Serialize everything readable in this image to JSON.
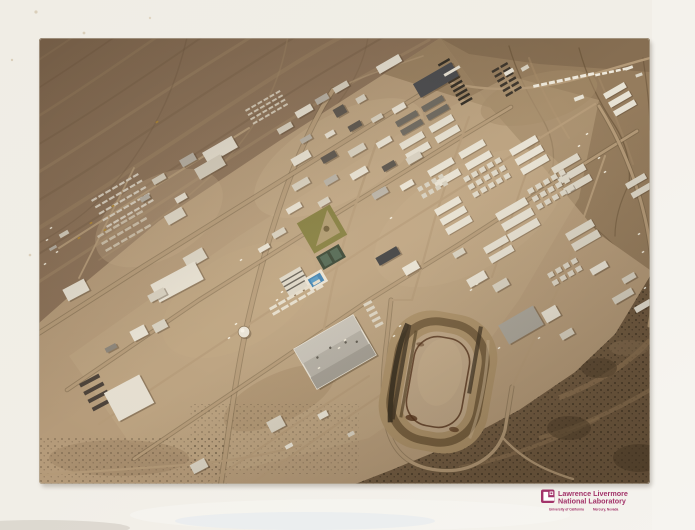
{
  "meta": {
    "title": "Glossy photographic print of an oblique aerial photograph",
    "subject": "Aerial view of a desert base-camp town with street grid, barracks rows, ball field, swimming pool and dirt racetrack, surrounded by alluvial fans, hills and scrub desert"
  },
  "label": {
    "org_line1": "Lawrence Livermore",
    "org_line2": "National Laboratory",
    "sub_left": "University of California",
    "sub_right": "Mercury, Nevada",
    "color": "#a23369"
  },
  "scene": {
    "colors": {
      "paper": "#f1eee7",
      "photo_base": "#b59b7a",
      "fan": "#8b7158",
      "fan_light": "#a68b6a",
      "fan_dark": "#6e573e",
      "hills": "#957c5d",
      "hills_dark": "#665036",
      "hills_light": "#b19671",
      "scrub": "#6f5940",
      "scrub_dot": "#3a2e1e",
      "wash": "#977c5a",
      "town_light": "#c2a986",
      "road": "#b49a78",
      "road_edge": "#6b583f",
      "roof_white": "#eae5d8",
      "roof_gray": "#b7b2a8",
      "roof_dark": "#45474c",
      "pool": "#3b7fb2",
      "field": "#7f7a3a",
      "field_dirt": "#b09a72",
      "tennis": "#31402f",
      "court": "#4a624f",
      "track_apron": "#ab9068",
      "track_berm": "#735c3c",
      "track_infield": "#bea687",
      "track_rail": "#5a3a22",
      "track_shadow": "#2b2316",
      "shadow": "#4a3a27",
      "vehicle": "#f2ecdc",
      "equipment": "#b58a2f"
    },
    "roads": [
      {
        "d": "M 182,446 C 190,390 198,330 210,278 C 220,234 238,170 258,122 C 266,103 274,86 284,68 L 294,52",
        "w": 4,
        "e": 1
      },
      {
        "d": "M 0,295 L 105,228 L 232,149 L 332,87 L 404,43",
        "w": 3.5,
        "e": 1
      },
      {
        "d": "M 28,352 L 160,262 L 300,174 L 422,99 L 472,69",
        "w": 2.8,
        "e": 1
      },
      {
        "d": "M 95,421 L 230,330 L 330,262 L 422,205 L 532,134 L 598,93",
        "w": 2.8,
        "e": 1
      },
      {
        "d": "M 60,386 L 200,293 L 340,201 L 480,113 L 556,66",
        "w": 2.2
      },
      {
        "d": "M 168,446 L 260,384 L 330,338",
        "w": 2
      },
      {
        "d": "M 212,446 L 300,385 L 352,350",
        "w": 2.2
      },
      {
        "d": "M 0,437 L 118,429 C 178,425 222,419 262,407",
        "w": 2.2
      },
      {
        "d": "M 338,103 L 322,150 L 306,200 L 294,245 L 285,290",
        "w": 2.4
      },
      {
        "d": "M 430,79 L 412,130 L 396,180 L 384,224 L 373,262",
        "w": 2.2
      },
      {
        "d": "M 500,99 L 482,150 L 466,200 L 453,239",
        "w": 2
      },
      {
        "d": "M 566,118 L 548,170 L 533,213 L 521,247",
        "w": 2
      },
      {
        "d": "M 560,68 C 580,100 597,140 606,180 C 615,219 616,255 610,288",
        "w": 3,
        "e": 1
      },
      {
        "d": "M 404,43 C 452,56 502,52 548,38 C 572,31 592,25 611,20",
        "w": 2.4
      },
      {
        "d": "M 294,52 C 324,38 354,28 384,18",
        "w": 1.6,
        "o": 0.6
      },
      {
        "d": "M 352,262 L 348,300 C 344,330 342,360 348,388 C 354,416 372,429 398,432 C 430,436 458,420 466,392 L 473,349",
        "w": 3.2,
        "e": 1
      },
      {
        "d": "M 464,400 C 482,420 504,432 534,441",
        "w": 2.4
      },
      {
        "d": "M 373,262 L 352,262",
        "w": 2
      },
      {
        "d": "M 20,210 L 120,146 L 210,90",
        "w": 2
      },
      {
        "d": "M 40,240 L 70,180 L 95,130",
        "w": 1.8
      },
      {
        "d": "M 473,349 L 521,247",
        "w": 2
      },
      {
        "d": "M 285,290 C 282,310 284,330 296,344",
        "w": 2
      }
    ],
    "buildings": [
      [
        350,
        26,
        26,
        8,
        -30,
        "#eae5d8"
      ],
      [
        397,
        42,
        44,
        16,
        -30,
        "#45474c"
      ],
      [
        413,
        33,
        18,
        3,
        -30,
        "#eae5d8"
      ],
      [
        302,
        49,
        16,
        6,
        -30,
        "#d9d3c4"
      ],
      [
        283,
        61,
        14,
        6,
        -30,
        "#b7b2a8"
      ],
      [
        265,
        73,
        18,
        7,
        -30,
        "#eae5d8"
      ],
      [
        301,
        73,
        12,
        9,
        -30,
        "#55504a"
      ],
      [
        322,
        61,
        10,
        6,
        -30,
        "#d9d3c4"
      ],
      [
        246,
        90,
        16,
        6,
        -30,
        "#d9d3c4"
      ],
      [
        267,
        101,
        12,
        5,
        -30,
        "#b7b2a8"
      ],
      [
        291,
        96,
        10,
        5,
        -30,
        "#eae5d8"
      ],
      [
        316,
        88,
        14,
        6,
        -30,
        "#55504a"
      ],
      [
        338,
        80,
        12,
        5,
        -30,
        "#d9d3c4"
      ],
      [
        360,
        70,
        14,
        6,
        -30,
        "#eae5d8"
      ],
      [
        181,
        112,
        34,
        13,
        -30,
        "#eae5d8"
      ],
      [
        171,
        129,
        30,
        12,
        -30,
        "#d9d3c4"
      ],
      [
        149,
        122,
        16,
        8,
        -30,
        "#b7b2a8"
      ],
      [
        120,
        141,
        14,
        6,
        -30,
        "#d9d3c4"
      ],
      [
        142,
        160,
        12,
        6,
        -30,
        "#eae5d8"
      ],
      [
        106,
        160,
        10,
        5,
        -30,
        "#b7b2a8"
      ],
      [
        136,
        178,
        20,
        10,
        -30,
        "#e2dccd"
      ],
      [
        156,
        220,
        22,
        12,
        -30,
        "#dfd9ca"
      ],
      [
        262,
        120,
        20,
        8,
        -30,
        "#eae5d8"
      ],
      [
        290,
        119,
        16,
        7,
        -30,
        "#55504a"
      ],
      [
        318,
        112,
        18,
        7,
        -30,
        "#d9d3c4"
      ],
      [
        345,
        104,
        16,
        6,
        -30,
        "#eae5d8"
      ],
      [
        262,
        146,
        18,
        7,
        -30,
        "#d9d3c4"
      ],
      [
        292,
        142,
        14,
        6,
        -30,
        "#b7b2a8"
      ],
      [
        320,
        135,
        18,
        7,
        -30,
        "#eae5d8"
      ],
      [
        350,
        128,
        14,
        6,
        -30,
        "#55504a"
      ],
      [
        375,
        120,
        16,
        7,
        -30,
        "#d9d3c4"
      ],
      [
        255,
        170,
        16,
        6,
        -30,
        "#eae5d8"
      ],
      [
        285,
        164,
        12,
        6,
        -30,
        "#d9d3c4"
      ],
      [
        341,
        155,
        16,
        7,
        -30,
        "#b7b2a8"
      ],
      [
        368,
        147,
        14,
        6,
        -30,
        "#eae5d8"
      ],
      [
        240,
        195,
        14,
        6,
        -30,
        "#d9d3c4"
      ],
      [
        225,
        210,
        12,
        5,
        -30,
        "#eae5d8"
      ],
      [
        349,
        218,
        24,
        9,
        -30,
        "#3a3c3f"
      ],
      [
        372,
        230,
        16,
        9,
        -30,
        "#eae5d8"
      ],
      [
        438,
        241,
        20,
        9,
        -30,
        "#eae5d8"
      ],
      [
        462,
        247,
        16,
        8,
        -30,
        "#d9d3c4"
      ],
      [
        420,
        215,
        12,
        6,
        -30,
        "#d9d3c4"
      ],
      [
        237,
        386,
        16,
        12,
        -28,
        "#d9d3c4"
      ],
      [
        284,
        377,
        10,
        6,
        -28,
        "#eae5d8"
      ],
      [
        250,
        408,
        8,
        4,
        -28,
        "#eae5d8"
      ],
      [
        312,
        396,
        7,
        4,
        -28,
        "#d9d3c4"
      ],
      [
        160,
        428,
        16,
        10,
        -28,
        "#d9d3c4"
      ],
      [
        138,
        244,
        50,
        20,
        -28,
        "#eae5d8"
      ],
      [
        118,
        257,
        18,
        8,
        -28,
        "#d9d3c4"
      ],
      [
        37,
        252,
        24,
        13,
        -28,
        "#eae5d8"
      ],
      [
        100,
        295,
        16,
        11,
        -28,
        "#eae5d8"
      ],
      [
        121,
        288,
        14,
        9,
        -28,
        "#d9d3c4"
      ],
      [
        90,
        360,
        40,
        32,
        -28,
        "#e4ded0"
      ],
      [
        72,
        310,
        12,
        5,
        -28,
        "#8a847a"
      ],
      [
        25,
        196,
        10,
        4,
        -30,
        "#d9d3c4"
      ],
      [
        14,
        210,
        8,
        3,
        -30,
        "#b7b2a8"
      ],
      [
        482,
        287,
        40,
        22,
        -30,
        "#a9a59b"
      ],
      [
        512,
        276,
        16,
        12,
        -30,
        "#eae5d8"
      ],
      [
        528,
        296,
        14,
        7,
        -30,
        "#d9d3c4"
      ],
      [
        584,
        258,
        22,
        7,
        -30,
        "#d9d3c4"
      ],
      [
        604,
        268,
        18,
        6,
        -30,
        "#eae5d8"
      ],
      [
        560,
        230,
        18,
        7,
        -30,
        "#eae5d8"
      ],
      [
        590,
        240,
        14,
        6,
        -30,
        "#d9d3c4"
      ],
      [
        470,
        34,
        10,
        4,
        -30,
        "#eae5d8"
      ],
      [
        486,
        30,
        8,
        4,
        -30,
        "#d9d3c4"
      ],
      [
        590,
        30,
        8,
        3,
        -20,
        "#eae5d8"
      ],
      [
        600,
        37,
        7,
        3,
        -20,
        "#d9d3c4"
      ],
      [
        540,
        60,
        10,
        4,
        -20,
        "#e7e2d4"
      ]
    ],
    "clusters": [
      {
        "x": 360,
        "y": 106,
        "rot": -30,
        "rows": 2,
        "cols": 2,
        "w": 26,
        "h": 7,
        "gx": 34,
        "gy": 12,
        "fill": "#e7e2d4",
        "name": "barracks-block"
      },
      {
        "x": 388,
        "y": 133,
        "rot": -30,
        "rows": 2,
        "cols": 2,
        "w": 28,
        "h": 7,
        "gx": 36,
        "gy": 13,
        "fill": "#e7e2d4",
        "name": "barracks-block"
      },
      {
        "x": 470,
        "y": 112,
        "rot": -30,
        "rows": 3,
        "cols": 1,
        "w": 30,
        "h": 7,
        "gx": 0,
        "gy": 11,
        "fill": "#e7e2d4",
        "name": "barracks-block"
      },
      {
        "x": 512,
        "y": 130,
        "rot": -30,
        "rows": 3,
        "cols": 1,
        "w": 30,
        "h": 7,
        "gx": 0,
        "gy": 12,
        "fill": "#ded8c9",
        "name": "barracks-block"
      },
      {
        "x": 395,
        "y": 172,
        "rot": -30,
        "rows": 3,
        "cols": 1,
        "w": 28,
        "h": 7,
        "gx": 0,
        "gy": 11,
        "fill": "#e7e2d4",
        "name": "barracks-block"
      },
      {
        "x": 456,
        "y": 176,
        "rot": -30,
        "rows": 3,
        "cols": 1,
        "w": 34,
        "h": 8,
        "gx": 0,
        "gy": 12,
        "fill": "#e7e2d4",
        "name": "barracks-block"
      },
      {
        "x": 526,
        "y": 196,
        "rot": -30,
        "rows": 2,
        "cols": 1,
        "w": 30,
        "h": 8,
        "gx": 0,
        "gy": 12,
        "fill": "#ded8c9",
        "name": "barracks-block"
      },
      {
        "x": 444,
        "y": 210,
        "rot": -30,
        "rows": 2,
        "cols": 1,
        "w": 26,
        "h": 7,
        "gx": 0,
        "gy": 11,
        "fill": "#e7e2d4",
        "name": "barracks-block"
      },
      {
        "x": 564,
        "y": 56,
        "rot": -30,
        "rows": 3,
        "cols": 1,
        "w": 24,
        "h": 6,
        "gx": 0,
        "gy": 10,
        "fill": "#e7e2d4",
        "name": "barracks-block"
      },
      {
        "x": 586,
        "y": 146,
        "rot": -30,
        "rows": 2,
        "cols": 1,
        "w": 22,
        "h": 6,
        "gx": 0,
        "gy": 11,
        "fill": "#ded8c9",
        "name": "barracks-block"
      },
      {
        "x": 356,
        "y": 84,
        "rot": -30,
        "rows": 2,
        "cols": 2,
        "w": 24,
        "h": 6,
        "gx": 30,
        "gy": 10,
        "fill": "#6a665e",
        "name": "dark-barracks-block"
      },
      {
        "x": 424,
        "y": 140,
        "rot": -30,
        "rows": 3,
        "cols": 5,
        "w": 6,
        "h": 5,
        "gx": 9,
        "gy": 9,
        "fill": "#ddd7c8",
        "name": "hutment-grid"
      },
      {
        "x": 488,
        "y": 152,
        "rot": -30,
        "rows": 3,
        "cols": 5,
        "w": 6,
        "h": 5,
        "gx": 9,
        "gy": 9,
        "fill": "#ddd7c8",
        "name": "hutment-grid"
      },
      {
        "x": 378,
        "y": 150,
        "rot": -30,
        "rows": 2,
        "cols": 4,
        "w": 5,
        "h": 4.5,
        "gx": 8,
        "gy": 8,
        "fill": "#d5cfc0",
        "name": "hutment-grid"
      },
      {
        "x": 508,
        "y": 236,
        "rot": -30,
        "rows": 2,
        "cols": 4,
        "w": 6,
        "h": 5,
        "gx": 9,
        "gy": 9,
        "fill": "#ddd7c8",
        "name": "hutment-grid"
      },
      {
        "x": 206,
        "y": 72,
        "rot": -30,
        "rows": 4,
        "cols": 6,
        "w": 5,
        "h": 2,
        "gx": 7,
        "gy": 5,
        "fill": "#d8cfbd",
        "ns": 1,
        "name": "laydown-yard"
      },
      {
        "x": 52,
        "y": 162,
        "rot": -30,
        "rows": 5,
        "cols": 7,
        "w": 6,
        "h": 2.2,
        "gx": 8,
        "gy": 7.5,
        "fill": "#ddd5c6",
        "ns": 1,
        "name": "motor-pool-rows"
      },
      {
        "x": 58,
        "y": 198,
        "rot": -30,
        "rows": 3,
        "cols": 6,
        "w": 7,
        "h": 2.5,
        "gx": 9,
        "gy": 8,
        "fill": "#cfc3ae",
        "ns": 1,
        "name": "motor-pool-rows"
      },
      {
        "x": 410,
        "y": 20,
        "rot": 60,
        "rows": 1,
        "cols": 10,
        "w": 2.5,
        "h": 13,
        "gx": 5,
        "gy": 0,
        "fill": "#2f2a22",
        "ns": 1,
        "name": "dark-trailer-rows"
      },
      {
        "x": 468,
        "y": 24,
        "rot": 60,
        "rows": 2,
        "cols": 6,
        "w": 2.5,
        "h": 8,
        "gx": 5.5,
        "gy": 10,
        "fill": "#3a332a",
        "ns": 1,
        "name": "dark-trailer-rows"
      },
      {
        "x": 494,
        "y": 47,
        "rot": -12,
        "rows": 1,
        "cols": 8,
        "w": 6,
        "h": 3,
        "gx": 8,
        "gy": 0,
        "fill": "#efe9dc",
        "ns": 1,
        "name": "white-trailer-row"
      },
      {
        "x": 556,
        "y": 36,
        "rot": -12,
        "rows": 1,
        "cols": 5,
        "w": 5,
        "h": 2.5,
        "gx": 7,
        "gy": 0,
        "fill": "#efe9dc",
        "ns": 1,
        "name": "white-trailer-row"
      },
      {
        "x": 40,
        "y": 346,
        "rot": -28,
        "rows": 4,
        "cols": 1,
        "w": 22,
        "h": 4,
        "gx": 0,
        "gy": 9,
        "fill": "#4a4038",
        "ns": 1,
        "name": "dark-barracks-rows"
      },
      {
        "x": 230,
        "y": 270,
        "rot": -30,
        "rows": 2,
        "cols": 6,
        "w": 8,
        "h": 3,
        "gx": 10,
        "gy": 6,
        "fill": "#e4ddcd",
        "ns": 1,
        "name": "parked-buses"
      },
      {
        "x": 332,
        "y": 262,
        "rot": 62,
        "rows": 1,
        "cols": 5,
        "w": 3,
        "h": 9,
        "gx": 6,
        "gy": 0,
        "fill": "#ddd6c6",
        "ns": 1,
        "name": "parked-vehicles"
      }
    ],
    "vehicles": [
      [
        190,
        300
      ],
      [
        197,
        286
      ],
      [
        238,
        262
      ],
      [
        243,
        254
      ],
      [
        300,
        310
      ],
      [
        306,
        302
      ],
      [
        355,
        298
      ],
      [
        361,
        288
      ],
      [
        432,
        252
      ],
      [
        438,
        246
      ],
      [
        560,
        120
      ],
      [
        566,
        134
      ],
      [
        600,
        196
      ],
      [
        604,
        214
      ],
      [
        352,
        180
      ],
      [
        202,
        222
      ],
      [
        280,
        330
      ],
      [
        460,
        310
      ],
      [
        500,
        300
      ],
      [
        606,
        250
      ],
      [
        12,
        190
      ],
      [
        8,
        202
      ],
      [
        18,
        214
      ],
      [
        6,
        226
      ],
      [
        540,
        108
      ],
      [
        548,
        96
      ]
    ],
    "equipment": [
      [
        52,
        185
      ],
      [
        66,
        192
      ],
      [
        40,
        200
      ],
      [
        118,
        84
      ],
      [
        74,
        168
      ]
    ]
  }
}
